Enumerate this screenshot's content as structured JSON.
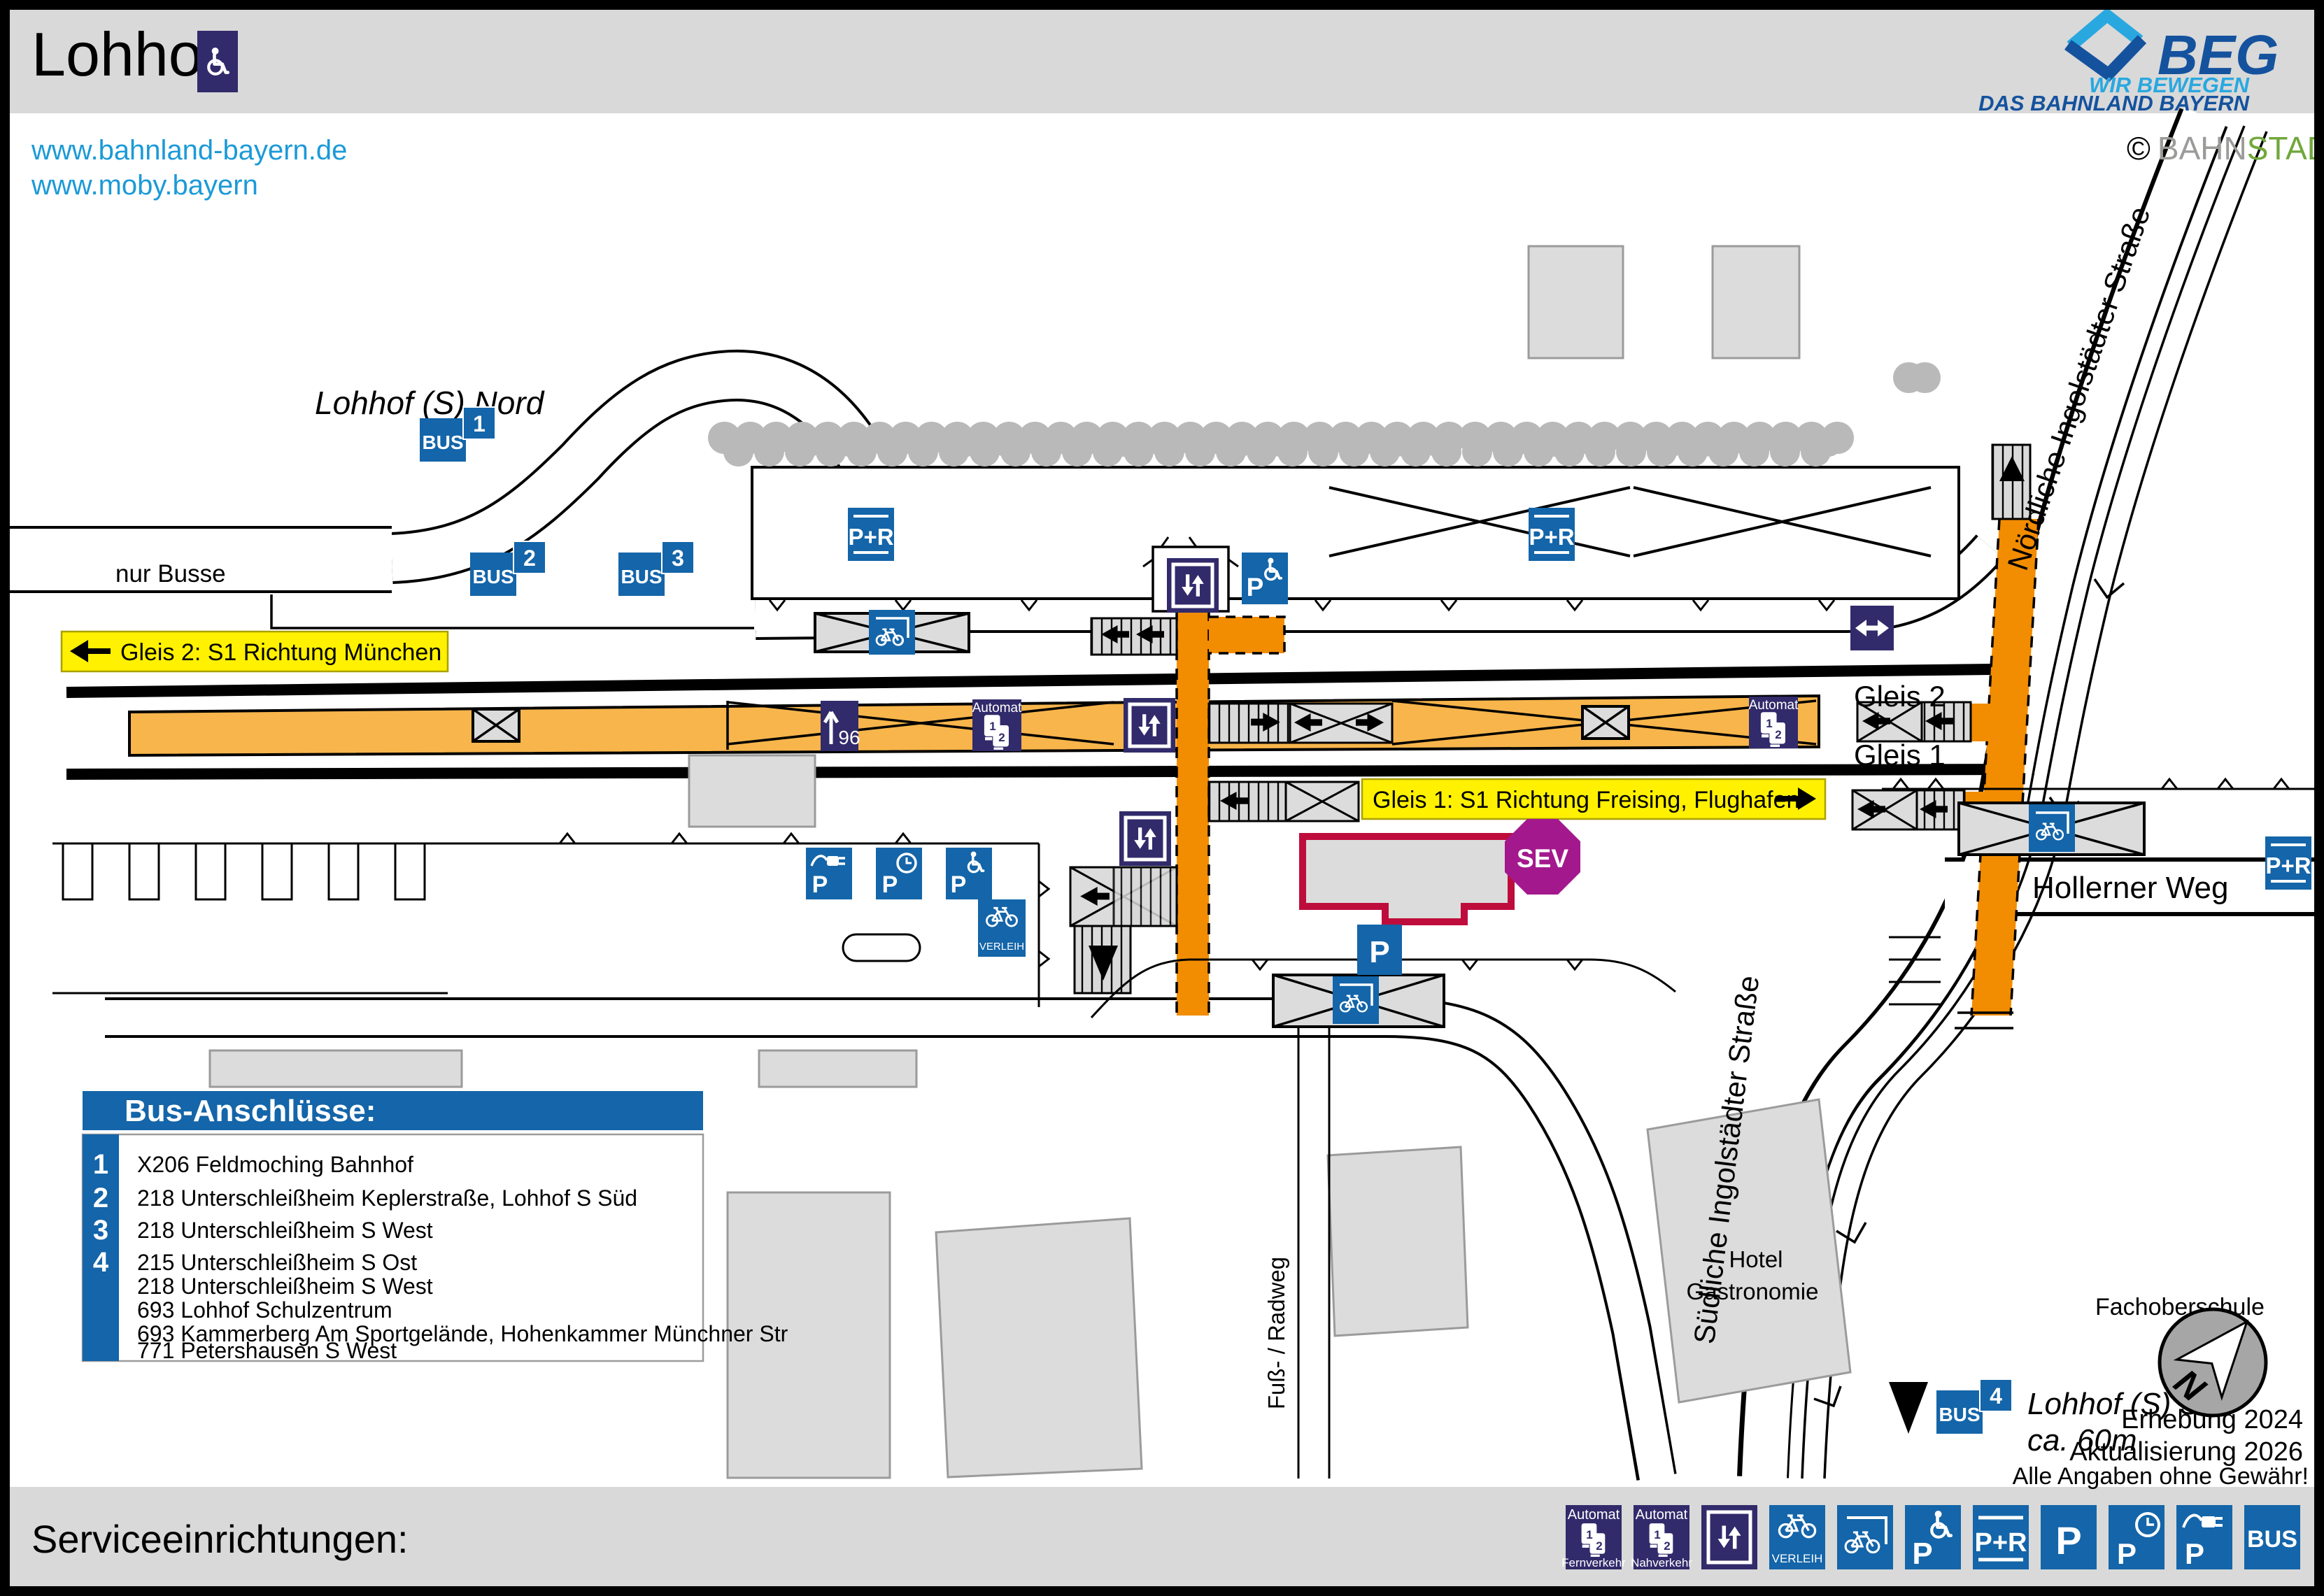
{
  "colors": {
    "navy_icon": "#312B6B",
    "blue_icon": "#1465A9",
    "platform_orange": "#F7B54B",
    "underpass_orange": "#F28C00",
    "direction_yellow": "#FFF100",
    "sev_purple": "#A3198D",
    "station_building_red": "#BE0D3C",
    "link_blue": "#1B9AD7",
    "beg_lightblue": "#29A8E0",
    "beg_darkblue": "#14529E",
    "gray_fill": "#DCDCDC",
    "tree_gray": "#B9B9B9"
  },
  "header": {
    "station_name": "Lohhof",
    "links": [
      "www.bahnland-bayern.de",
      "www.moby.bayern"
    ],
    "beg_logo": {
      "name": "BEG",
      "tagline1": "WIR BEWEGEN",
      "tagline2": "DAS BAHNLAND BAYERN"
    },
    "credit": {
      "symbol": "©",
      "part_gray": "BAHN",
      "part_green": "STADT"
    }
  },
  "direction_labels": {
    "gleis2": "Gleis 2: S1 Richtung München",
    "gleis1": "Gleis 1: S1 Richtung Freising, Flughafen"
  },
  "map_labels": {
    "lohhof_nord": "Lohhof (S) Nord",
    "nur_busse": "nur Busse",
    "gleis2": "Gleis 2",
    "gleis1": "Gleis 1",
    "hollerner_weg": "Hollerner Weg",
    "noerdliche": "Nördliche Ingolstädter Straße",
    "suedliche": "Südliche Ingolstädter Straße",
    "fachoberschule": "Fachoberschule",
    "hotel_line1": "Hotel",
    "hotel_line2": "Gastronomie",
    "fuss_radweg": "Fuß- / Radweg",
    "lohhof_sued": "Lohhof (S) Süd",
    "lohhof_sued_distance": "ca. 60m",
    "platform_length": "96",
    "sev": "SEV",
    "north": "N"
  },
  "icon_labels": {
    "automat": "Automat",
    "verleih": "VERLEIH",
    "p": "P",
    "p_r": "P+R",
    "bus": "BUS",
    "digit1": "1",
    "digit2": "2"
  },
  "bus_stop_numbers": [
    "1",
    "2",
    "3",
    "4"
  ],
  "bus_connections": {
    "title": "Bus-Anschlüsse:",
    "entries": [
      {
        "number": "1",
        "lines": [
          "X206 Feldmoching Bahnhof"
        ]
      },
      {
        "number": "2",
        "lines": [
          "218 Unterschleißheim Keplerstraße, Lohhof S Süd"
        ]
      },
      {
        "number": "3",
        "lines": [
          "218 Unterschleißheim S West"
        ]
      },
      {
        "number": "4",
        "lines": [
          "215 Unterschleißheim S Ost",
          "218 Unterschleißheim S West",
          "693 Lohhof Schulzentrum",
          "693 Kammerberg Am Sportgelände, Hohenkammer Münchner Str",
          "771 Petershausen S West"
        ]
      }
    ]
  },
  "notes": {
    "survey": "Erhebung 2024",
    "update": "Aktualisierung 2026",
    "disclaimer": "Alle Angaben ohne Gewähr!"
  },
  "footer": {
    "title": "Serviceeinrichtungen:",
    "automat_fern": "Fernverkehr",
    "automat_nah": "Nahverkehr"
  }
}
